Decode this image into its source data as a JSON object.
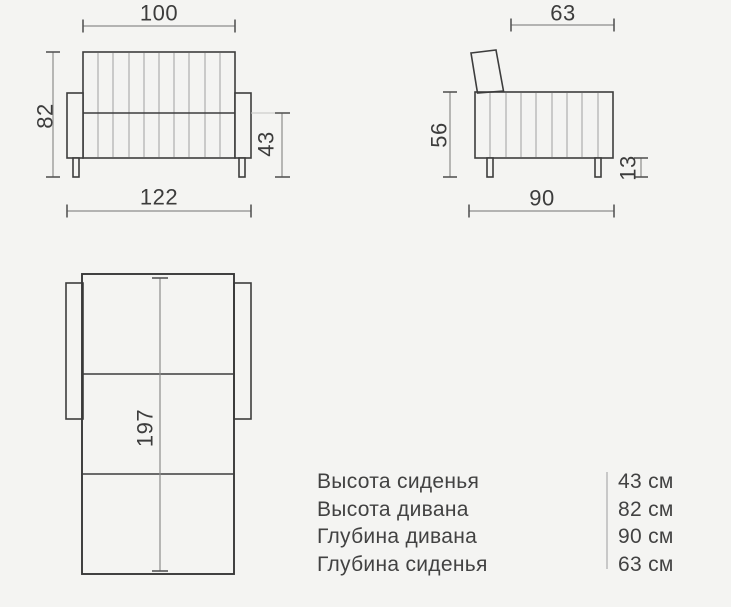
{
  "colors": {
    "background": "#f4f4f2",
    "outline": "#3d3d3d",
    "dimension_line": "#8c8c8c",
    "text": "#3c3c3c",
    "legend_divider": "#c8c8c8"
  },
  "front_view": {
    "top_width": "100",
    "total_height": "82",
    "bottom_width": "122",
    "seat_height": "43"
  },
  "side_view": {
    "seat_depth": "63",
    "body_height": "56",
    "total_depth": "90",
    "leg_height": "13"
  },
  "top_view": {
    "unfolded_length": "197"
  },
  "legend": {
    "rows": [
      {
        "label": "Высота сиденья",
        "value": "43 см"
      },
      {
        "label": "Высота дивана",
        "value": "82 см"
      },
      {
        "label": "Глубина дивана",
        "value": "90 см"
      },
      {
        "label": "Глубина сиденья",
        "value": "63 см"
      }
    ]
  }
}
